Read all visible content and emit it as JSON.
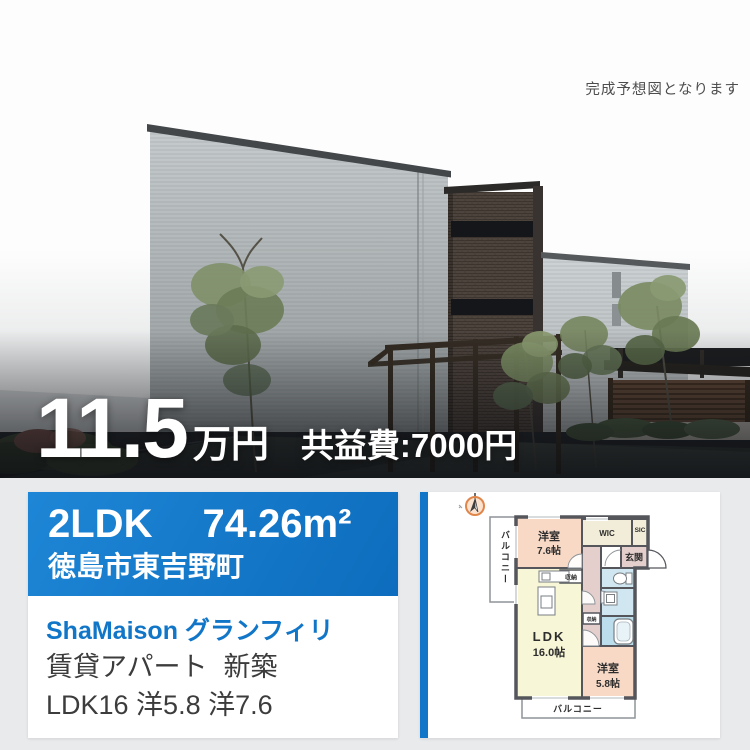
{
  "brand": {
    "accent_blue": "#1176c8"
  },
  "photo": {
    "disclaimer": "完成予想図となります",
    "price_value": "11.5",
    "price_unit": "万円",
    "maintenance_fee": "共益費:7000円"
  },
  "listing": {
    "layout_type": "2LDK",
    "area": "74.26m²",
    "address": "徳島市東吉野町",
    "building_name": "ShaMaison グランフィリ",
    "property_type": "賃貸アパート",
    "build_status": "新築",
    "rooms_summary": "LDK16 洋5.8 洋7.6"
  },
  "floorplan": {
    "balcony_left": "バルコニー",
    "balcony_bottom": "バルコニー",
    "bedroom_large_name": "洋室",
    "bedroom_large_size": "7.6帖",
    "bedroom_small_name": "洋室",
    "bedroom_small_size": "5.8帖",
    "ldk_name": "LDK",
    "ldk_size": "16.0帖",
    "wic": "WIC",
    "sic": "SIC",
    "entrance": "玄関",
    "closet_ldk": "収納",
    "closet_hall": "収納",
    "room_colors": {
      "bedroom": "#f7d9c6",
      "ldk": "#f7f6d6",
      "hall": "#e4cfcc",
      "wet_area": "#d0e7f1",
      "bath": "#bcdeec",
      "storage": "#f2edd8"
    }
  }
}
